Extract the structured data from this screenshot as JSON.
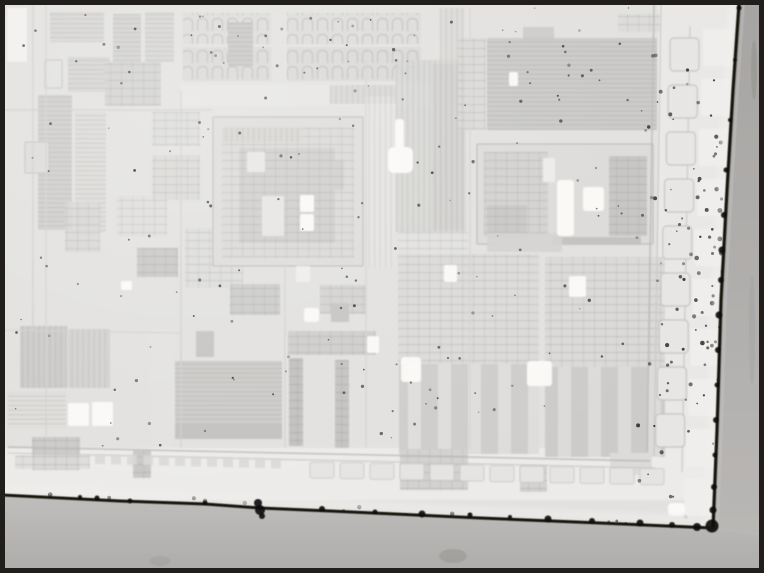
{
  "figure": {
    "alt": "Grayscale optical microscope photograph of an integrated circuit die corner, showing rectangular circuit blocks, a bond-pad ring, dark die edges along the right and bottom, dust speckles, and a black figure frame",
    "width": 764,
    "height": 573
  },
  "frame": {
    "outer_hairline": "#949290",
    "border": "#221e1c",
    "thickness": 5
  },
  "palette": {
    "die_surface": "#e2e1df",
    "vignette_light": "#ffffff",
    "edge_line": "#16130f",
    "blob": "#0c0a09",
    "speckle": "#2b2927",
    "outside_right_top": "#a7a5a3",
    "outside_right_bottom": "#b9b7b5",
    "outside_bottom_top": "#c0bebc",
    "outside_bottom_bottom": "#afadab",
    "feather": "#f0efed",
    "sheen": "#c6c4c2",
    "smudge": "#6f6d6b"
  },
  "blocks_format": "[x, y, w, h, fill, texture(h|v|g|a|b|null), opacity, stroke]",
  "blocks": [
    [
      658,
      4,
      84,
      496,
      "#e9e8e6",
      null,
      1,
      null
    ],
    [
      2,
      448,
      740,
      52,
      "#ecebe9",
      null,
      1,
      null
    ],
    [
      7,
      8,
      20,
      54,
      "#f1f0ee",
      null,
      1,
      null
    ],
    [
      50,
      12,
      54,
      30,
      "#d7d6d4",
      "h",
      1,
      null
    ],
    [
      113,
      14,
      28,
      48,
      "#d2d1cf",
      "h",
      1,
      null
    ],
    [
      145,
      12,
      29,
      50,
      "#d6d5d3",
      "h",
      1,
      null
    ],
    [
      45,
      60,
      17,
      28,
      "#e2e1df",
      null,
      1,
      "#c2c1bf"
    ],
    [
      68,
      57,
      42,
      35,
      "#d5d4d2",
      "h",
      1,
      null
    ],
    [
      105,
      62,
      56,
      44,
      "#d2d1cf",
      "g",
      1,
      null
    ],
    [
      38,
      95,
      34,
      135,
      "#cfcecc",
      "h",
      1,
      null
    ],
    [
      75,
      112,
      31,
      120,
      "#d9d8d6",
      "h",
      0.75,
      null
    ],
    [
      152,
      112,
      48,
      34,
      "#dbdad8",
      "g",
      0.85,
      null
    ],
    [
      152,
      155,
      48,
      45,
      "#d8d7d5",
      "g",
      0.85,
      null
    ],
    [
      25,
      142,
      24,
      31,
      "#dcdbd9",
      null,
      1,
      "#c1c0be"
    ],
    [
      65,
      202,
      35,
      50,
      "#d7d6d4",
      "g",
      0.8,
      null
    ],
    [
      137,
      248,
      41,
      29,
      "#c9c8c6",
      "g",
      1,
      null
    ],
    [
      185,
      228,
      58,
      60,
      "#dcdbd9",
      "g",
      0.7,
      null
    ],
    [
      117,
      196,
      50,
      40,
      "#dddcda",
      "g",
      0.6,
      null
    ],
    [
      20,
      326,
      47,
      62,
      "#cccbc9",
      "v",
      1,
      null
    ],
    [
      68,
      329,
      42,
      59,
      "#d3d2d0",
      "v",
      1,
      null
    ],
    [
      8,
      392,
      58,
      36,
      "#dedddb",
      "h",
      0.8,
      null
    ],
    [
      32,
      437,
      48,
      33,
      "#cbcac8",
      "g",
      1,
      null
    ],
    [
      133,
      450,
      18,
      28,
      "#c9c8c6",
      "g",
      1,
      null
    ],
    [
      150,
      330,
      25,
      118,
      "#e3e2e0",
      null,
      1,
      null
    ],
    [
      15,
      455,
      75,
      14,
      "#dcdbd9",
      "g",
      0.8,
      null
    ],
    [
      183,
      13,
      238,
      31,
      "#dcdbd9",
      "a",
      1,
      null
    ],
    [
      183,
      47,
      238,
      34,
      "#d9d8d6",
      "a",
      1,
      null
    ],
    [
      271,
      13,
      16,
      68,
      "#e3e2e0",
      null,
      0.9,
      null
    ],
    [
      228,
      22,
      25,
      44,
      "#c8c7c5",
      "h",
      1,
      null
    ],
    [
      180,
      84,
      298,
      22,
      "#e6e5e3",
      null,
      1,
      null
    ],
    [
      330,
      85,
      66,
      19,
      "#d7d6d4",
      "v",
      1,
      null
    ],
    [
      440,
      8,
      24,
      78,
      "#d9d8d6",
      "v",
      0.8,
      null
    ],
    [
      618,
      14,
      42,
      18,
      "#dad9d7",
      "g",
      0.7,
      null
    ],
    [
      213,
      117,
      150,
      149,
      "#dddcda",
      null,
      1,
      "#b7b6b4"
    ],
    [
      222,
      127,
      132,
      131,
      "#d8d7d5",
      "g",
      0.55,
      null
    ],
    [
      239,
      148,
      96,
      95,
      "#cfcecc",
      "g",
      1,
      null
    ],
    [
      262,
      196,
      22,
      40,
      "#e5e4e2",
      null,
      1,
      null
    ],
    [
      247,
      152,
      18,
      20,
      "#e7e6e4",
      null,
      1,
      null
    ],
    [
      318,
      160,
      26,
      30,
      "#cfcecc",
      "g",
      1,
      null
    ],
    [
      222,
      128,
      80,
      14,
      "#d4d3d1",
      "v",
      0.8,
      null
    ],
    [
      364,
      96,
      30,
      172,
      "#e7e6e4",
      "v",
      0.5,
      null
    ],
    [
      396,
      60,
      70,
      172,
      "#d5d4d2",
      "v",
      0.8,
      null
    ],
    [
      432,
      64,
      32,
      166,
      "#d0cfcd",
      "v",
      0.7,
      null
    ],
    [
      458,
      38,
      28,
      92,
      "#d8d7d5",
      "g",
      0.8,
      null
    ],
    [
      523,
      27,
      31,
      14,
      "#cccbc9",
      null,
      1,
      null
    ],
    [
      487,
      38,
      170,
      92,
      "#c7c6c4",
      "h",
      0.85,
      null
    ],
    [
      477,
      144,
      176,
      100,
      "#dcdbd9",
      null,
      1,
      "#b4b3b1"
    ],
    [
      484,
      152,
      64,
      84,
      "#d3d2d0",
      "g",
      1,
      null
    ],
    [
      487,
      205,
      40,
      33,
      "#c9c8c6",
      "g",
      1,
      null
    ],
    [
      543,
      158,
      12,
      24,
      "#ecebe9",
      null,
      1,
      null
    ],
    [
      609,
      156,
      38,
      80,
      "#c6c5c3",
      "g",
      1,
      null
    ],
    [
      553,
      237,
      88,
      8,
      "#c2c1bf",
      null,
      1,
      null
    ],
    [
      398,
      232,
      70,
      20,
      "#e2e1df",
      "g",
      0.5,
      null
    ],
    [
      487,
      233,
      75,
      19,
      "#d3d2d0",
      null,
      0.9,
      null
    ],
    [
      398,
      254,
      141,
      110,
      "#dbdad8",
      "g",
      1,
      null
    ],
    [
      545,
      257,
      120,
      110,
      "#dad9d7",
      "g",
      1,
      null
    ],
    [
      399,
      364,
      140,
      90,
      "#dedddb",
      "b",
      1,
      null
    ],
    [
      545,
      367,
      120,
      90,
      "#dcdbd9",
      "b",
      1,
      null
    ],
    [
      175,
      361,
      107,
      62,
      "#cdccca",
      "h",
      1,
      null
    ],
    [
      175,
      423,
      107,
      16,
      "#c3c2c0",
      null,
      1,
      null
    ],
    [
      289,
      358,
      14,
      88,
      "#c2c1bf",
      "g",
      1,
      null
    ],
    [
      335,
      360,
      14,
      88,
      "#c4c3c1",
      "g",
      1,
      null
    ],
    [
      288,
      331,
      88,
      24,
      "#cfcecc",
      "g",
      1,
      null
    ],
    [
      196,
      331,
      18,
      26,
      "#c6c5c3",
      null,
      1,
      null
    ],
    [
      230,
      284,
      50,
      31,
      "#ccccca",
      "g",
      1,
      null
    ],
    [
      320,
      285,
      46,
      29,
      "#d4d3d1",
      "g",
      1,
      null
    ],
    [
      331,
      303,
      18,
      19,
      "#c6c5c3",
      null,
      1,
      null
    ],
    [
      296,
      266,
      14,
      16,
      "#eeedeb",
      null,
      1,
      null
    ],
    [
      400,
      449,
      68,
      41,
      "#d2d1cf",
      "g",
      1,
      null
    ],
    [
      520,
      465,
      27,
      27,
      "#d3d2d0",
      "g",
      1,
      null
    ],
    [
      610,
      453,
      42,
      22,
      "#dcdbd9",
      null,
      1,
      null
    ]
  ],
  "lines_format": "[x1,y1,x2,y2,width,color]",
  "lines": [
    [
      654,
      4,
      647,
      452,
      1.4,
      "#bcbbb9"
    ],
    [
      661,
      4,
      654,
      456,
      1.1,
      "#c8c7c5"
    ],
    [
      8,
      447,
      650,
      461,
      1.4,
      "#bcbbb9"
    ],
    [
      8,
      453,
      655,
      468,
      1.1,
      "#c8c7c5"
    ],
    [
      690,
      26,
      682,
      472,
      1.3,
      "#cbcac8"
    ],
    [
      33,
      4,
      33,
      330,
      1.2,
      "#cfcecc"
    ],
    [
      46,
      4,
      46,
      438,
      1.2,
      "#d2d1cf"
    ],
    [
      4,
      110,
      212,
      110,
      1.2,
      "#cfcecc"
    ],
    [
      181,
      90,
      181,
      448,
      1.2,
      "#d0cfcd"
    ],
    [
      285,
      266,
      285,
      448,
      1.2,
      "#d3d2d0"
    ],
    [
      366,
      60,
      366,
      448,
      1.2,
      "#d2d1cf"
    ],
    [
      470,
      8,
      470,
      448,
      1.2,
      "#d4d3d1"
    ],
    [
      4,
      330,
      180,
      333,
      1.1,
      "#d2d1cf"
    ]
  ],
  "pads": {
    "inner_column": {
      "x": 670,
      "y0": 38,
      "w": 29,
      "h": 33,
      "step": 47,
      "count": 9,
      "dx_per_pad": -1.8,
      "fill": "#e7e6e4",
      "stroke": "#c3c2c0"
    },
    "outer_column": {
      "x": 703,
      "y0": 29,
      "w": 29,
      "h": 37,
      "step": 50,
      "count": 10,
      "dx_per_pad": -2.1,
      "fill": "#efeeec"
    },
    "bottom_squares": {
      "x0": 95,
      "y": 454,
      "w": 10,
      "h": 10,
      "step": 16,
      "count": 12,
      "dy_per_pad": 0.4,
      "fill": "#d8d7d5"
    },
    "bottom_row": {
      "x0": 310,
      "y": 462,
      "w": 24,
      "h": 16,
      "step": 30,
      "count": 12,
      "dy_per_pad": 0.6,
      "fill": "#e5e4e2",
      "stroke": "#cccbc9"
    }
  },
  "highlights_format": "[x,y,w,h,rx]",
  "highlights": [
    [
      388,
      147,
      25,
      26,
      6
    ],
    [
      395,
      119,
      9,
      30,
      3
    ],
    [
      509,
      72,
      9,
      14,
      2
    ],
    [
      121,
      281,
      11,
      9,
      2
    ],
    [
      300,
      195,
      14,
      17,
      2
    ],
    [
      300,
      214,
      14,
      17,
      2
    ],
    [
      68,
      403,
      21,
      23,
      2
    ],
    [
      92,
      402,
      21,
      24,
      2
    ],
    [
      401,
      357,
      20,
      25,
      3
    ],
    [
      527,
      361,
      25,
      25,
      3
    ],
    [
      444,
      265,
      13,
      17,
      2
    ],
    [
      569,
      276,
      17,
      21,
      2
    ],
    [
      367,
      336,
      12,
      17,
      2
    ],
    [
      304,
      308,
      15,
      14,
      3
    ],
    [
      668,
      503,
      17,
      13,
      4
    ],
    [
      557,
      180,
      17,
      56,
      3
    ],
    [
      583,
      187,
      21,
      24,
      3
    ]
  ],
  "edges": {
    "right": {
      "points": [
        [
          739,
          4
        ],
        [
          733,
          90
        ],
        [
          727,
          190
        ],
        [
          721,
          300
        ],
        [
          717,
          430
        ],
        [
          713,
          528
        ]
      ],
      "width": 3.2,
      "blobs": [
        [
          739,
          8,
          2.5
        ],
        [
          735,
          60,
          2
        ],
        [
          730,
          120,
          2
        ],
        [
          726,
          170,
          2.5
        ],
        [
          724,
          215,
          3
        ],
        [
          722,
          250,
          3.5
        ],
        [
          721,
          280,
          3
        ],
        [
          719,
          315,
          3.5
        ],
        [
          718,
          350,
          3
        ],
        [
          717,
          385,
          2.5
        ],
        [
          716,
          420,
          3
        ],
        [
          715,
          455,
          2.5
        ],
        [
          714,
          487,
          3
        ],
        [
          713,
          510,
          3.5
        ],
        [
          712,
          526,
          6.5
        ]
      ]
    },
    "bottom": {
      "points": [
        [
          2,
          495
        ],
        [
          120,
          501
        ],
        [
          205,
          504
        ],
        [
          260,
          508
        ],
        [
          330,
          511
        ],
        [
          480,
          518
        ],
        [
          600,
          523
        ],
        [
          713,
          528
        ]
      ],
      "width": 3,
      "blobs": [
        [
          80,
          497,
          2
        ],
        [
          97,
          498,
          2.5
        ],
        [
          130,
          501,
          2.5
        ],
        [
          205,
          503,
          2.5
        ],
        [
          258,
          503,
          4
        ],
        [
          260,
          510,
          5
        ],
        [
          262,
          516,
          3
        ],
        [
          322,
          509,
          3
        ],
        [
          375,
          512,
          2.5
        ],
        [
          422,
          514,
          3.5
        ],
        [
          470,
          515,
          2.5
        ],
        [
          510,
          517,
          2
        ],
        [
          548,
          519,
          3.5
        ],
        [
          592,
          521,
          3
        ],
        [
          640,
          523,
          3.5
        ],
        [
          672,
          525,
          3
        ],
        [
          697,
          527,
          4
        ]
      ]
    }
  },
  "smudges_format": "[cx,cy,rx,ry,opacity]",
  "smudges": [
    [
      453,
      556,
      14,
      7,
      0.22
    ],
    [
      160,
      561,
      11,
      5,
      0.13
    ],
    [
      754,
      70,
      3,
      30,
      0.22
    ],
    [
      752,
      330,
      3,
      55,
      0.1
    ]
  ],
  "speckles": {
    "seed": 42,
    "color": "#2b2927",
    "regions": [
      {
        "count": 150,
        "x": [
          10,
          690
        ],
        "y": [
          8,
          448
        ],
        "r": [
          0.7,
          1.7
        ],
        "op": [
          0.3,
          0.75
        ]
      },
      {
        "count": 55,
        "x": [
          638,
          724
        ],
        "y": [
          40,
          498
        ],
        "r": [
          0.8,
          2.1
        ],
        "op": [
          0.45,
          0.9
        ]
      },
      {
        "count": 32,
        "x": [
          694,
          722
        ],
        "y": [
          110,
          408
        ],
        "r": [
          1.0,
          2.5
        ],
        "op": [
          0.55,
          0.95
        ]
      },
      {
        "count": 26,
        "x": [
          20,
          700
        ],
        "follow": "bottom",
        "dy": [
          -6,
          5
        ],
        "r": [
          1.0,
          2.4
        ],
        "op": [
          0.5,
          0.9
        ]
      },
      {
        "count": 10,
        "x": [
          60,
          700
        ],
        "y": [
          505,
          555
        ],
        "r": [
          1.0,
          2.2
        ],
        "op": [
          0.15,
          0.4
        ]
      },
      {
        "count": 18,
        "x": [
          185,
          420
        ],
        "y": [
          14,
          80
        ],
        "r": [
          0.7,
          1.5
        ],
        "op": [
          0.3,
          0.6
        ]
      },
      {
        "count": 14,
        "x": [
          487,
          657
        ],
        "y": [
          40,
          128
        ],
        "r": [
          0.8,
          1.8
        ],
        "op": [
          0.4,
          0.8
        ]
      }
    ]
  }
}
